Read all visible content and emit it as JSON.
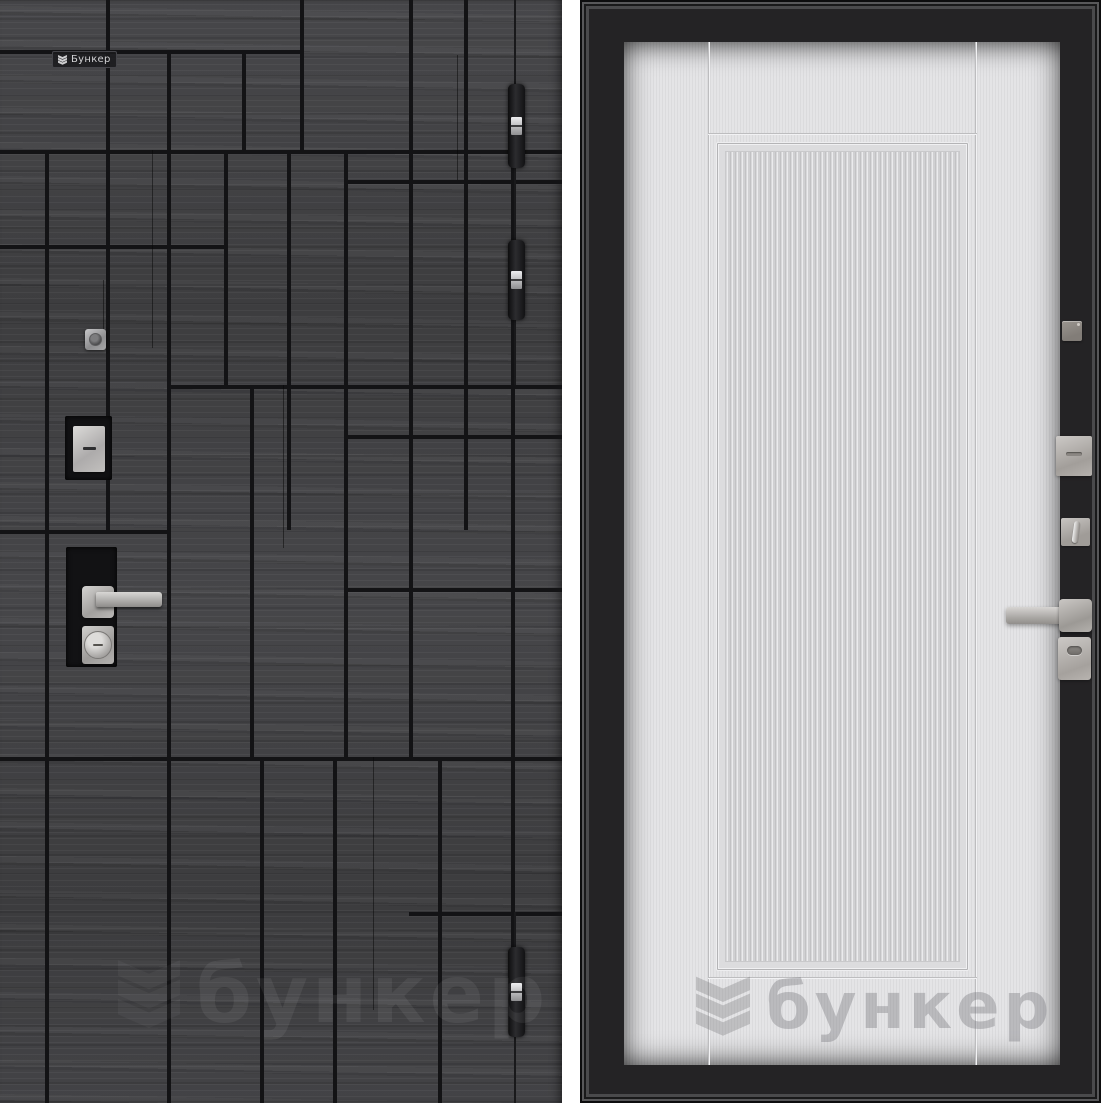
{
  "brand": {
    "badge_label": "Бункер",
    "watermark_text": "бункер"
  },
  "colors": {
    "background": "#ffffff",
    "wood_base": "#434345",
    "seam_black": "#131315",
    "frame_black": "#242325",
    "leaf_light": "#e0e0e2",
    "metal_light": "#d6d4d2",
    "metal_dark": "#8e8c8a"
  },
  "left_panel": {
    "hardware_icons": [
      "hinge-icon",
      "hinge-icon",
      "hinge-icon",
      "peephole-icon",
      "lock-cover-icon",
      "lever-handle-icon",
      "lock-cylinder-icon"
    ],
    "hinge_count": 3
  },
  "right_panel": {
    "hardware_icons": [
      "peephole-cover-icon",
      "lock-plate-icon",
      "thumbturn-icon",
      "lever-handle-icon",
      "keyhole-escutcheon-icon"
    ]
  }
}
